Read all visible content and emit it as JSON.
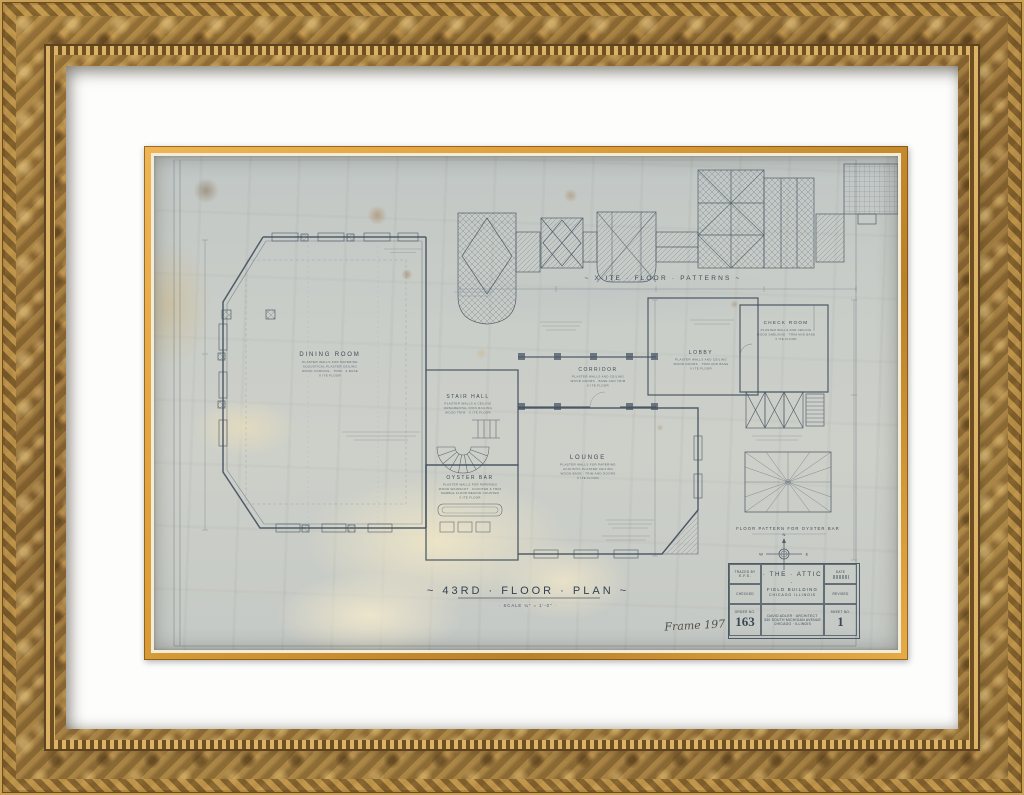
{
  "drawing": {
    "plan_title": "~ 43RD · FLOOR · PLAN ~",
    "plan_scale": "· SCALE  ¼\" = 1'-0\" ·",
    "frame_note": "Frame 197",
    "pattern_heading": "~ X·ITE · FLOOR · PATTERNS ~",
    "oyster_caption": "FLOOR PATTERN FOR OYSTER BAR",
    "compass": {
      "n": "N",
      "e": "E",
      "s": "S",
      "w": "W"
    },
    "rooms": [
      {
        "label": "DINING ROOM",
        "notes": [
          "PLASTER WALLS FOR PAPERING",
          "ACOUSTICAL PLASTER CEILING",
          "WOOD CORNICE · TRIM · & BASE",
          "X ITE FLOOR"
        ]
      },
      {
        "label": "STAIR HALL",
        "notes": [
          "PLASTER WALLS & CEILING",
          "ORNAMENTAL IRON RAILING",
          "WOOD TRIM · X ITE FLOOR"
        ]
      },
      {
        "label": "CORRIDOR",
        "notes": [
          "PLASTER WALLS AND CEILING",
          "WOOD DOORS · BASE AND TRIM",
          "X ITE FLOOR"
        ]
      },
      {
        "label": "LOBBY",
        "notes": [
          "PLASTER WALLS AND CEILING",
          "WOOD DOORS · TRIM AND BASE",
          "X ITE FLOOR"
        ]
      },
      {
        "label": "CHECK ROOM",
        "notes": [
          "PLASTER WALLS AND CEILING",
          "WOOD SHELVING · TRIM AND BASE",
          "X ITE FLOOR"
        ]
      },
      {
        "label": "LOUNGE",
        "notes": [
          "PLASTER WALLS FOR PAPERING",
          "ACOUSTIC PLASTER CEILING",
          "WOOD BASE · TRIM AND DOORS",
          "X ITE FLOOR"
        ]
      },
      {
        "label": "OYSTER BAR",
        "notes": [
          "PLASTER WALLS FOR PAPERING",
          "WOOD WAINSCOT · COUNTER & TRIM",
          "MARBLE FLOOR BEHIND COUNTER",
          "X ITE FLOOR"
        ]
      }
    ],
    "title_block": {
      "traced_label": "TRACED BY",
      "traced_value": "E.F.S.",
      "checked_label": "CHECKED",
      "order_label": "ORDER NO.",
      "order_no": "163",
      "project_line1": "· THE · ATTIC ·",
      "project_line2": "FIELD BUILDING",
      "project_line3": "CHICAGO ILLINOIS",
      "arch_line1": "DAVID ADLER · ARCHITECT",
      "arch_line2": "330 SOUTH MICHIGAN AVENUE",
      "arch_line3": "CHICAGO · ILLINOIS",
      "date_label": "DATE",
      "revised_label": "REVISED",
      "sheet_label": "SHEET NO.",
      "sheet_no": "1"
    }
  },
  "colors": {
    "frame_gold": "#9c7a3e",
    "mat_white": "#fdfdfc",
    "fillet_gold": "#e0a23d",
    "paper": "#c7ccc9",
    "ink": "#45525f"
  }
}
